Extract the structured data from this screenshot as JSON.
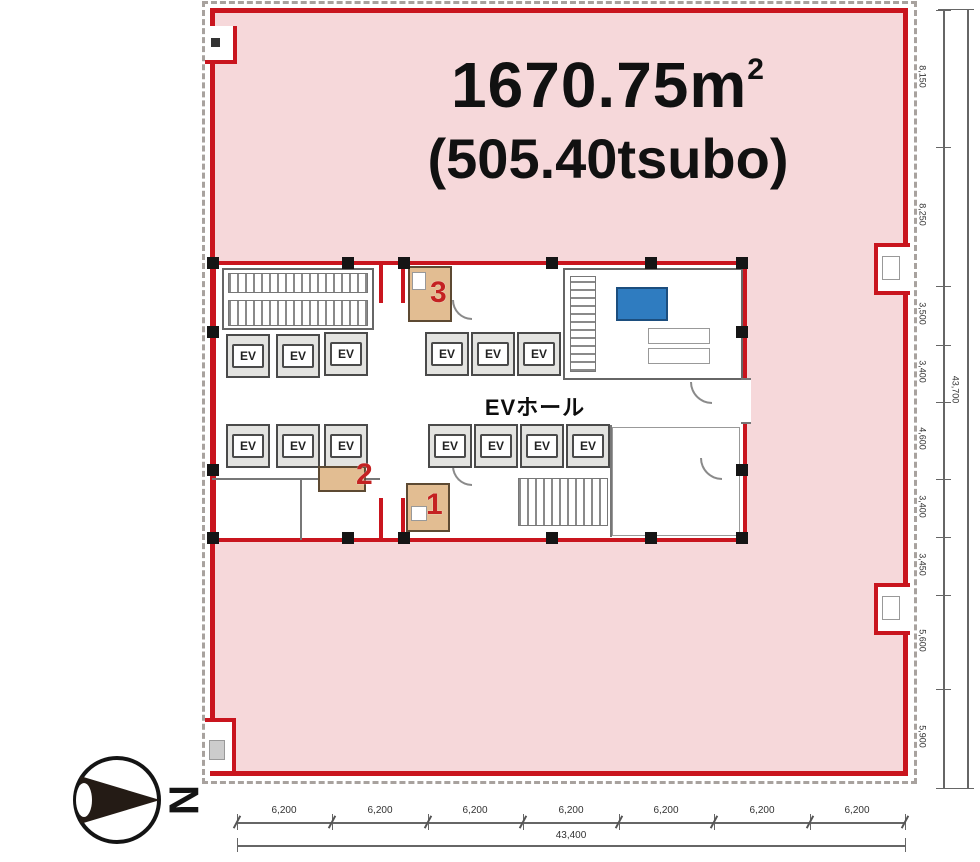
{
  "title": {
    "area_value": "1670.75m",
    "area_sup": "2",
    "tsubo": "(505.40tsubo)"
  },
  "core": {
    "ev_hall": "EVホール",
    "ev": "EV",
    "elevator_count": 13
  },
  "markers": {
    "m1": "1",
    "m2": "2",
    "m3": "3"
  },
  "compass": {
    "north": "N"
  },
  "dims": {
    "bottom": {
      "segments": [
        "6,200",
        "6,200",
        "6,200",
        "6,200",
        "6,200",
        "6,200",
        "6,200"
      ],
      "total": "43,400"
    },
    "right": {
      "segments": [
        "8,150",
        "8,250",
        "3,500",
        "3,400",
        "4,600",
        "3,400",
        "3,450",
        "5,600",
        "5,900"
      ],
      "total": "43,700"
    }
  },
  "colors": {
    "leased_pink": "#f6d8da",
    "outline_red": "#c9151e",
    "highlight_blue": "#2f7cc0",
    "highlight_tan": "#e2bd92",
    "marker_red": "#c42222"
  }
}
